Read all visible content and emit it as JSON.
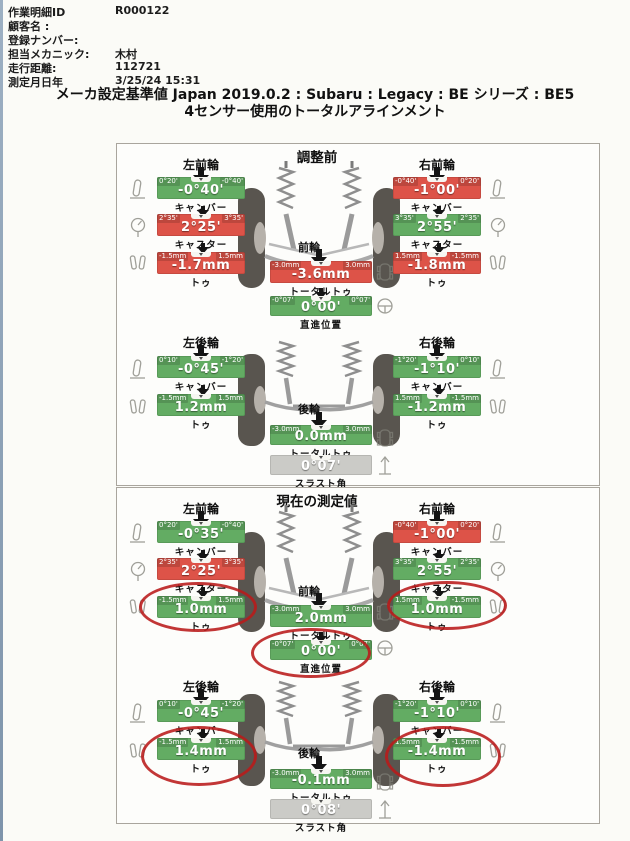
{
  "header": {
    "fields": [
      {
        "label": "作業明細ID",
        "value": "R000122"
      },
      {
        "label": "顧客名 :",
        "value": ""
      },
      {
        "label": "登録ナンバー:",
        "value": ""
      },
      {
        "label": "担当メカニック:",
        "value": "木村"
      },
      {
        "label": "走行距離:",
        "value": "112721"
      },
      {
        "label": "測定月日年",
        "value": "3/25/24 15:31"
      }
    ],
    "title_line1": "メーカ設定基準値 Japan 2019.0.2 : Subaru : Legacy : BE シリーズ : BE5",
    "title_line2": "4センサー使用のトータルアラインメント"
  },
  "colors": {
    "in_spec": "#63ac63",
    "out_of_spec": "#dd5348",
    "neutral": "#cbcbc7",
    "annotation": "#ba1a1a"
  },
  "icons": [
    "camber-icon",
    "caster-icon",
    "toe-icon",
    "vehicle-icon",
    "steering-icon",
    "thrust-icon"
  ],
  "panels": [
    {
      "title": "調整前",
      "front": {
        "left_wheel": "左前輪",
        "right_wheel": "右前輪",
        "axle_label": "前輪",
        "lf_camber": {
          "label": "キャンバー",
          "value": "-0°40'",
          "min": "0°20'",
          "max": "-0°40'",
          "status": "ok"
        },
        "lf_caster": {
          "label": "キャスター",
          "value": "2°25'",
          "min": "2°35'",
          "max": "3°35'",
          "status": "ng"
        },
        "lf_toe": {
          "label": "トゥ",
          "value": "-1.7mm",
          "min": "-1.5mm",
          "max": "1.5mm",
          "status": "ng"
        },
        "rf_camber": {
          "label": "キャンバー",
          "value": "-1°00'",
          "min": "-0°40'",
          "max": "0°20'",
          "status": "ng"
        },
        "rf_caster": {
          "label": "キャスター",
          "value": "2°55'",
          "min": "3°35'",
          "max": "2°35'",
          "status": "ok"
        },
        "rf_toe": {
          "label": "トゥ",
          "value": "-1.8mm",
          "min": "1.5mm",
          "max": "-1.5mm",
          "status": "ng"
        },
        "total_toe": {
          "label": "トータルトゥ",
          "value": "-3.6mm",
          "min": "-3.0mm",
          "max": "3.0mm",
          "status": "ng"
        },
        "straight": {
          "label": "直進位置",
          "value": "0°00'",
          "min": "-0°07'",
          "max": "0°07'",
          "status": "ok"
        }
      },
      "rear": {
        "left_wheel": "左後輪",
        "right_wheel": "右後輪",
        "axle_label": "後輪",
        "lr_camber": {
          "label": "キャンバー",
          "value": "-0°45'",
          "min": "0°10'",
          "max": "-1°20'",
          "status": "ok"
        },
        "lr_toe": {
          "label": "トゥ",
          "value": "1.2mm",
          "min": "-1.5mm",
          "max": "1.5mm",
          "status": "ok"
        },
        "rr_camber": {
          "label": "キャンバー",
          "value": "-1°10'",
          "min": "-1°20'",
          "max": "0°10'",
          "status": "ok"
        },
        "rr_toe": {
          "label": "トゥ",
          "value": "-1.2mm",
          "min": "1.5mm",
          "max": "-1.5mm",
          "status": "ok"
        },
        "total_toe": {
          "label": "トータルトゥ",
          "value": "0.0mm",
          "min": "-3.0mm",
          "max": "3.0mm",
          "status": "ok"
        },
        "thrust": {
          "label": "スラスト角",
          "value": "0°07'",
          "min": "",
          "max": "",
          "status": "na"
        }
      }
    },
    {
      "title": "現在の測定値",
      "circled_items": [
        "lf_toe",
        "rf_toe",
        "straight",
        "lr_toe",
        "rr_toe"
      ],
      "front": {
        "left_wheel": "左前輪",
        "right_wheel": "右前輪",
        "axle_label": "前輪",
        "lf_camber": {
          "label": "キャンバー",
          "value": "-0°35'",
          "min": "0°20'",
          "max": "-0°40'",
          "status": "ok"
        },
        "lf_caster": {
          "label": "キャスター",
          "value": "2°25'",
          "min": "2°35'",
          "max": "3°35'",
          "status": "ng"
        },
        "lf_toe": {
          "label": "トゥ",
          "value": "1.0mm",
          "min": "-1.5mm",
          "max": "1.5mm",
          "status": "ok"
        },
        "rf_camber": {
          "label": "キャンバー",
          "value": "-1°00'",
          "min": "-0°40'",
          "max": "0°20'",
          "status": "ng"
        },
        "rf_caster": {
          "label": "キャスター",
          "value": "2°55'",
          "min": "3°35'",
          "max": "2°35'",
          "status": "ok"
        },
        "rf_toe": {
          "label": "トゥ",
          "value": "1.0mm",
          "min": "1.5mm",
          "max": "-1.5mm",
          "status": "ok"
        },
        "total_toe": {
          "label": "トータルトゥ",
          "value": "2.0mm",
          "min": "-3.0mm",
          "max": "3.0mm",
          "status": "ok"
        },
        "straight": {
          "label": "直進位置",
          "value": "0°00'",
          "min": "-0°07'",
          "max": "0°07'",
          "status": "ok"
        }
      },
      "rear": {
        "left_wheel": "左後輪",
        "right_wheel": "右後輪",
        "axle_label": "後輪",
        "lr_camber": {
          "label": "キャンバー",
          "value": "-0°45'",
          "min": "0°10'",
          "max": "-1°20'",
          "status": "ok"
        },
        "lr_toe": {
          "label": "トゥ",
          "value": "1.4mm",
          "min": "-1.5mm",
          "max": "1.5mm",
          "status": "ok"
        },
        "rr_camber": {
          "label": "キャンバー",
          "value": "-1°10'",
          "min": "-1°20'",
          "max": "0°10'",
          "status": "ok"
        },
        "rr_toe": {
          "label": "トゥ",
          "value": "-1.4mm",
          "min": "1.5mm",
          "max": "-1.5mm",
          "status": "ok"
        },
        "total_toe": {
          "label": "トータルトゥ",
          "value": "-0.1mm",
          "min": "-3.0mm",
          "max": "3.0mm",
          "status": "ok"
        },
        "thrust": {
          "label": "スラスト角",
          "value": "0°08'",
          "min": "",
          "max": "",
          "status": "na"
        }
      }
    }
  ]
}
